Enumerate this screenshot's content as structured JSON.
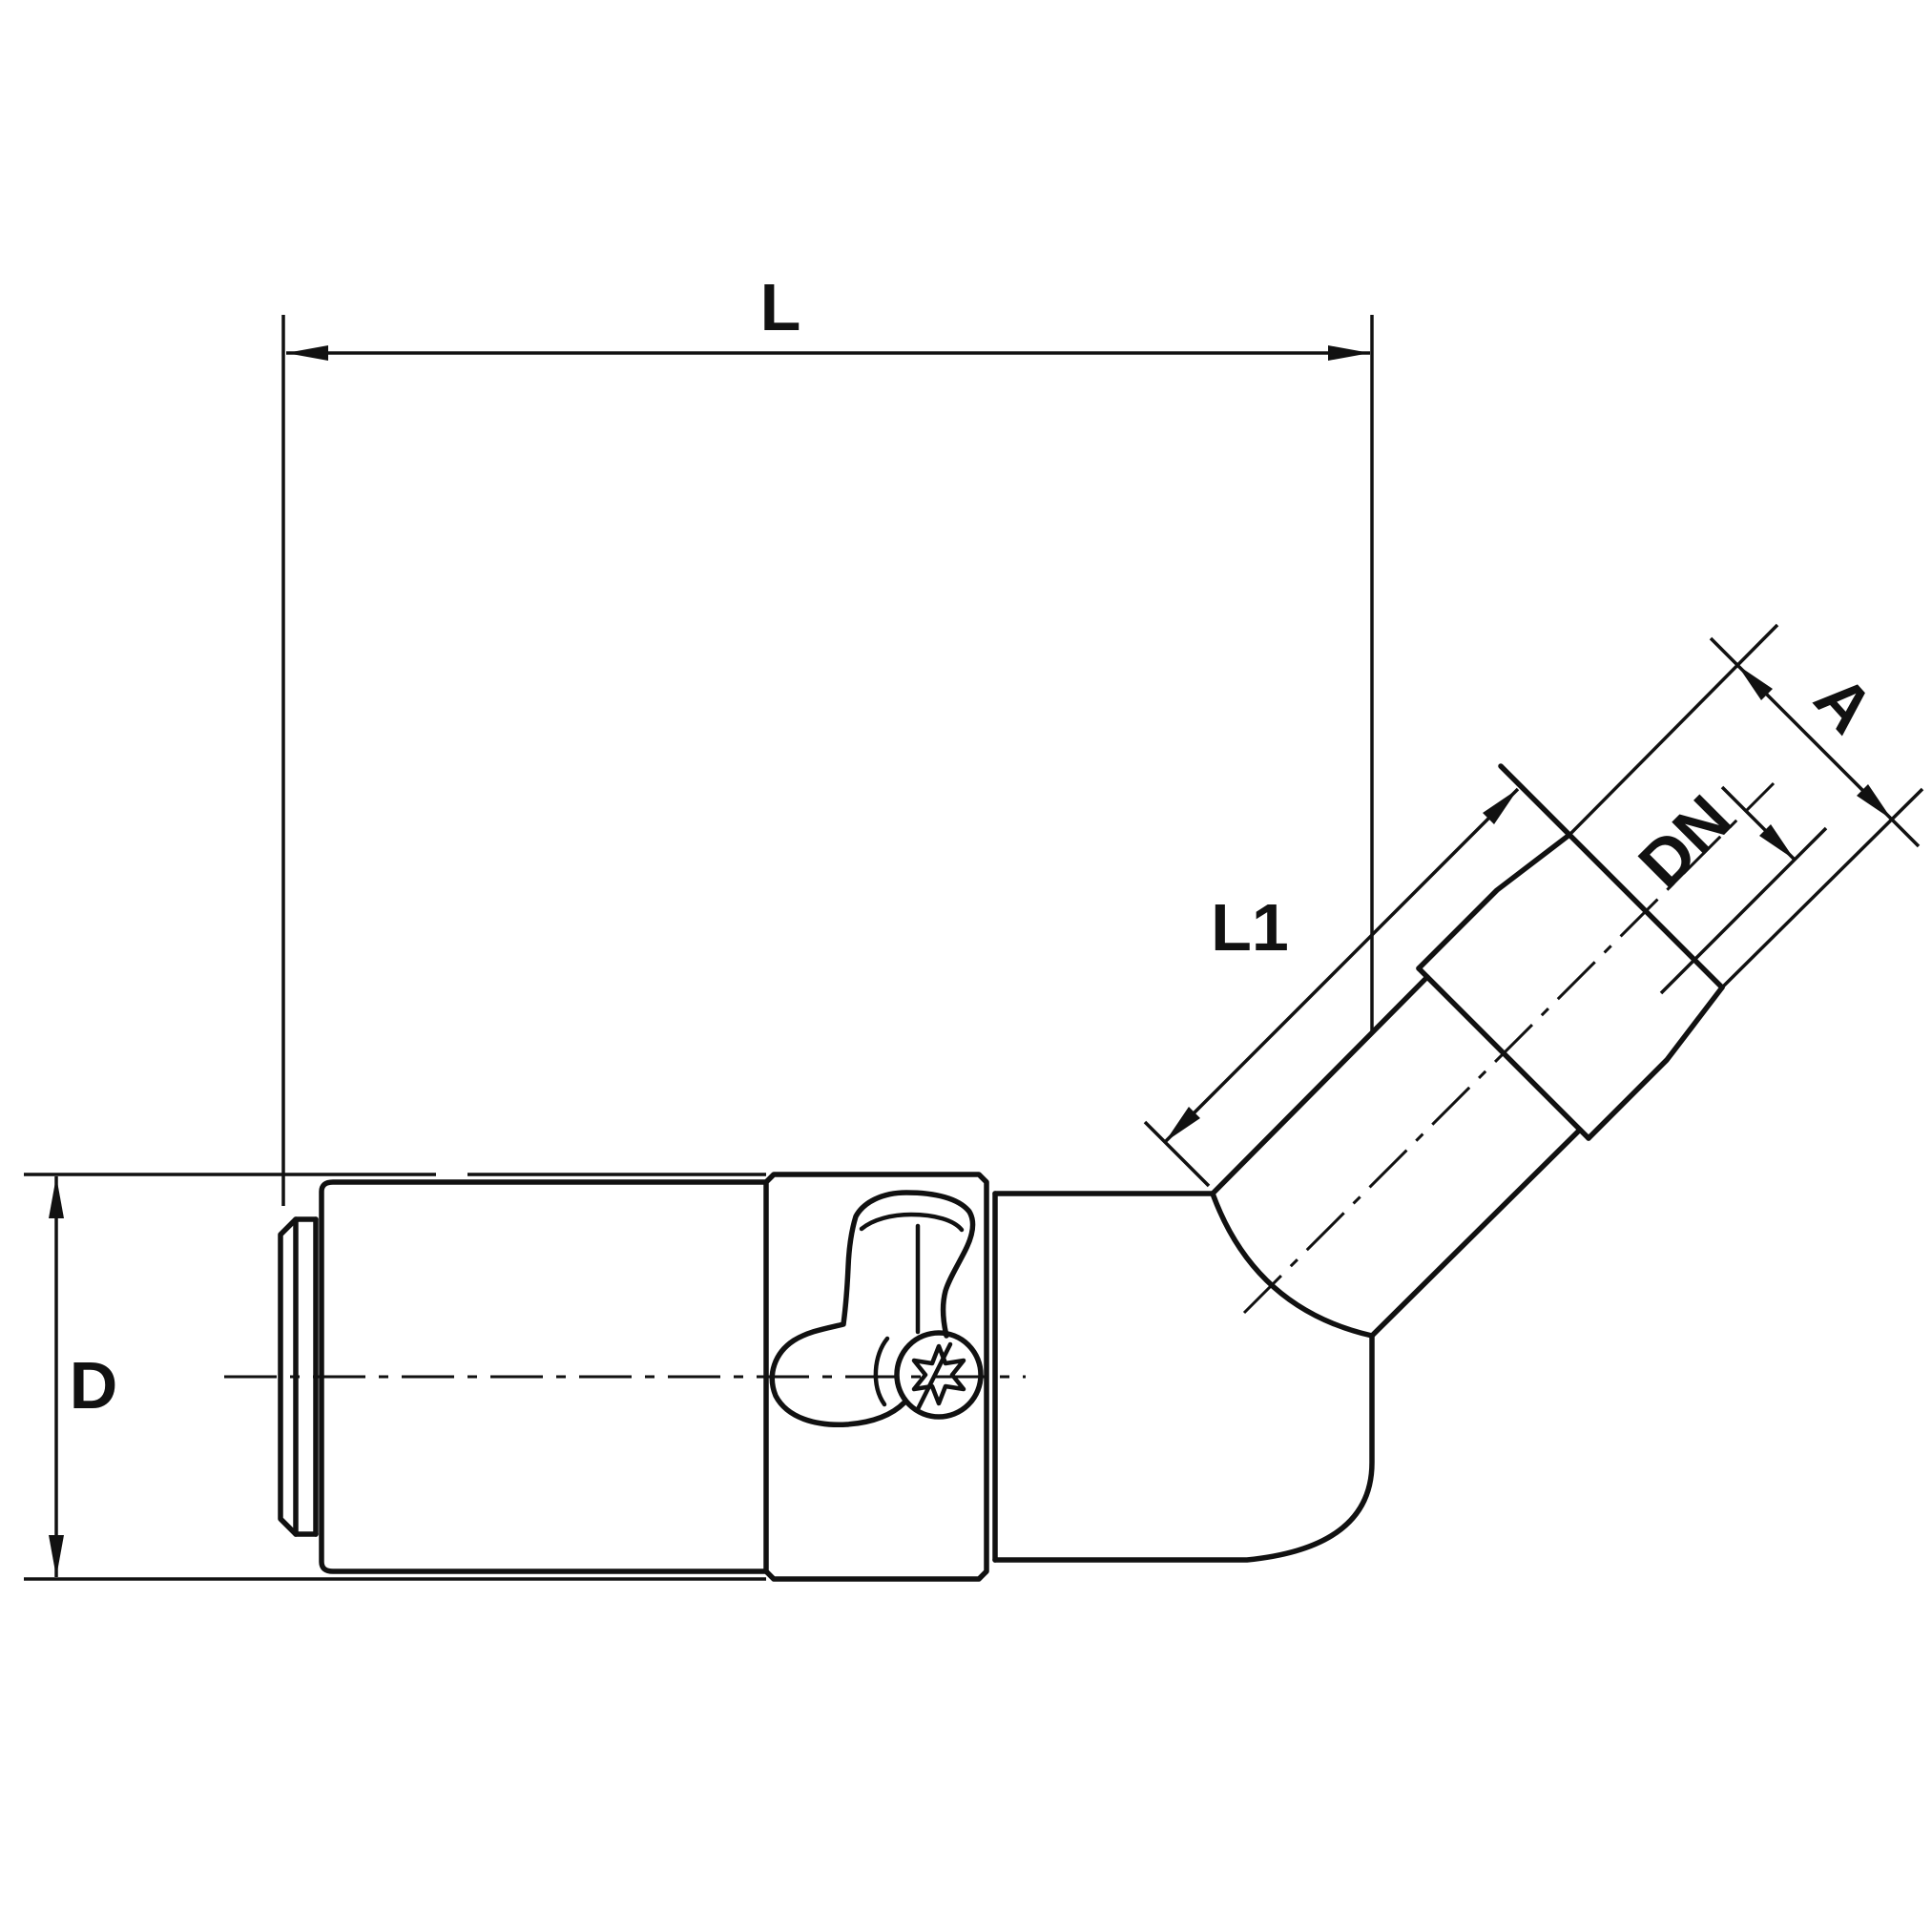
{
  "drawing": {
    "kind": "technical-drawing",
    "subject": "45-degree elbow push-in fitting with male threaded end, side view",
    "colors": {
      "line": "#111111",
      "background": "#ffffff"
    },
    "dimensions": {
      "overall_length": {
        "label": "L"
      },
      "body_diameter": {
        "label": "D"
      },
      "elbow_length": {
        "label": "L1"
      },
      "nominal_diameter": {
        "label": "DN"
      },
      "thread_dimension": {
        "label": "A"
      }
    }
  }
}
